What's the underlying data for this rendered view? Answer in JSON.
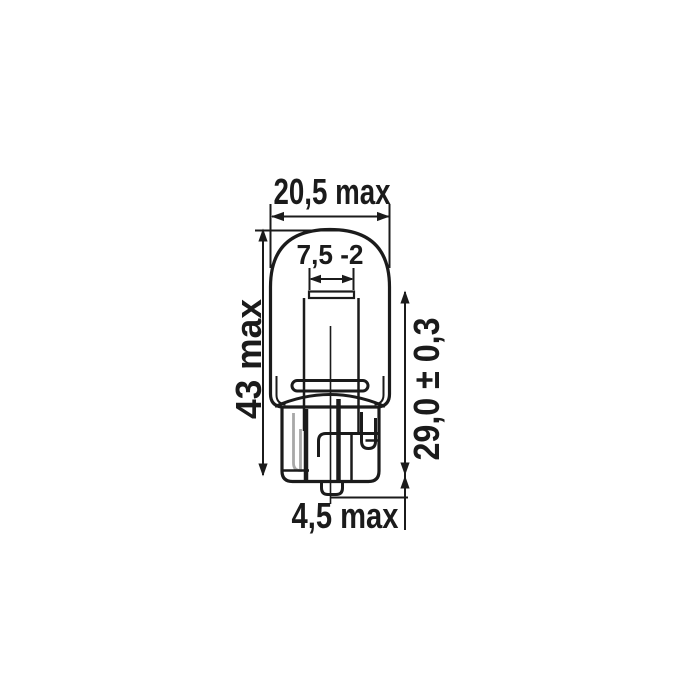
{
  "drawing": {
    "type": "bulb-dimension-diagram",
    "labels": {
      "bulb_width": "20,5 max",
      "pinch_width": "7,5 -2",
      "overall_length": "43 max",
      "base_length": "29,0 ± 0,3",
      "wedge_tip_length": "4,5 max"
    },
    "colors": {
      "line": "#1b1b1b",
      "light_wire": "#a8a8a8",
      "background": "#ffffff"
    }
  }
}
